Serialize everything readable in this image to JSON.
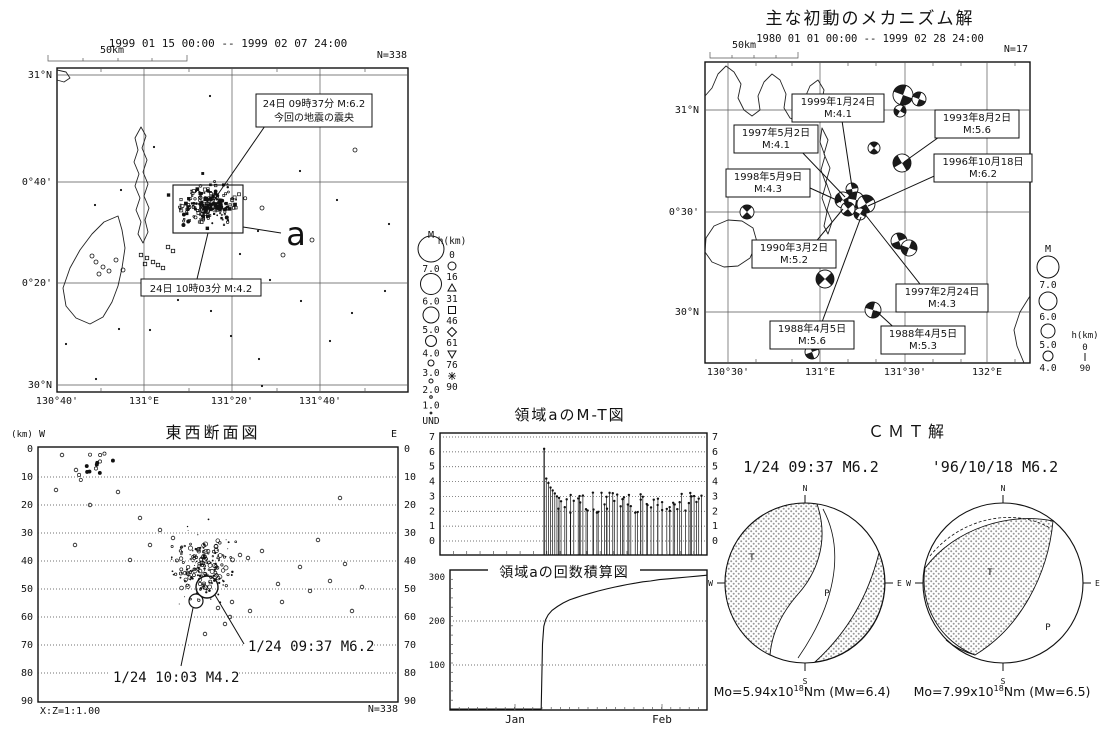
{
  "colors": {
    "ink": "#111111",
    "paper": "#ffffff",
    "hatch": "#8f8f8f"
  },
  "panel_a": {
    "period": "1999 01 15 00:00 -- 1999 02 07 24:00",
    "scale_label": "50km",
    "count_label": "N=338",
    "lat_ticks": [
      "31°N",
      "0°40'",
      "0°20'",
      "30°N"
    ],
    "lon_ticks": [
      "130°40'",
      "131°E",
      "131°20'",
      "131°40'"
    ],
    "callout_main_line1": "24日 09時37分 M:6.2",
    "callout_main_line2": "今回の地震の震央",
    "callout_aftershock": "24日 10時03分 M:4.2",
    "region_label": "a",
    "legend": {
      "m_header": "M",
      "m_items": [
        "7.0",
        "6.0",
        "5.0",
        "4.0",
        "3.0",
        "2.0",
        "1.0",
        "UND"
      ],
      "h_header": "h(km)",
      "h_items": [
        "0",
        "16",
        "31",
        "46",
        "61",
        "76",
        "90"
      ]
    }
  },
  "panel_b": {
    "title": "主な初動のメカニズム解",
    "period": "1980 01 01 00:00 -- 1999 02 28 24:00",
    "scale_label": "50km",
    "count_label": "N=17",
    "lat_ticks": [
      "31°N",
      "0°30'",
      "30°N"
    ],
    "lon_ticks": [
      "130°30'",
      "131°E",
      "131°30'",
      "132°E"
    ],
    "callouts": [
      {
        "date": "1999年1月24日",
        "mag": "M:4.1"
      },
      {
        "date": "1993年8月2日",
        "mag": "M:5.6"
      },
      {
        "date": "1997年5月2日",
        "mag": "M:4.1"
      },
      {
        "date": "1998年5月9日",
        "mag": "M:4.3"
      },
      {
        "date": "1996年10月18日",
        "mag": "M:6.2"
      },
      {
        "date": "1990年3月2日",
        "mag": "M:5.2"
      },
      {
        "date": "1997年2月24日",
        "mag": "M:4.3"
      },
      {
        "date": "1988年4月5日",
        "mag": "M:5.6"
      },
      {
        "date": "1988年4月5日",
        "mag": "M:5.3"
      }
    ],
    "legend": {
      "m_header": "M",
      "m_items": [
        "7.0",
        "6.0",
        "5.0",
        "4.0"
      ],
      "h_header": "h(km)",
      "h_top": "0",
      "h_bottom": "90"
    }
  },
  "panel_c": {
    "title": "東西断面図",
    "unit": "(km)",
    "west": "W",
    "east": "E",
    "depth_ticks": [
      "0",
      "10",
      "20",
      "30",
      "40",
      "50",
      "60",
      "70",
      "80",
      "90"
    ],
    "ratio": "X:Z=1:1.00",
    "count_label": "N=338",
    "label_mainshock": "1/24 09:37 M6.2",
    "label_aftershock": "1/24 10:03 M4.2"
  },
  "panel_d": {
    "title": "領域aのM-T図",
    "y_ticks": [
      "7",
      "6",
      "5",
      "4",
      "3",
      "2",
      "1",
      "0"
    ]
  },
  "panel_e": {
    "title": "領域aの回数積算図",
    "y_ticks": [
      "300",
      "200",
      "100"
    ],
    "x_ticks": [
      "Jan",
      "Feb"
    ]
  },
  "panel_f": {
    "title": "ＣＭＴ解",
    "compass": [
      "N",
      "W",
      "E",
      "S"
    ],
    "t_label": "T",
    "p_label": "P",
    "events": [
      {
        "title": "1/24 09:37 M6.2",
        "mo_prefix": "Mo=5.94x10",
        "mo_exp": "18",
        "mo_suffix": "Nm (Mw=6.4)"
      },
      {
        "title": "'96/10/18 M6.2",
        "mo_prefix": "Mo=7.99x10",
        "mo_exp": "18",
        "mo_suffix": "Nm (Mw=6.5)"
      }
    ]
  },
  "chart_data": [
    {
      "id": "epicenter-map",
      "type": "scatter",
      "title": "1999 01 15 00:00 -- 1999 02 07 24:00",
      "n": 338,
      "lon_ticks": [
        "130°40'",
        "131°E",
        "131°20'",
        "131°40'"
      ],
      "lat_ticks": [
        "31°N",
        "0°40'",
        "0°20'",
        "30°N"
      ],
      "mainshock": {
        "label": "24日 09時37分 M:6.2",
        "m": 6.2,
        "note": "今回の地震の震央"
      },
      "aftershock": {
        "label": "24日 10時03分 M:4.2",
        "m": 4.2
      },
      "region": "a",
      "cluster": {
        "approx_lon": "131°15'",
        "approx_lat": "30°35'",
        "n_points": 210
      },
      "background_n_points": 36,
      "legend_m": [
        7.0,
        6.0,
        5.0,
        4.0,
        3.0,
        2.0,
        1.0,
        "UND"
      ],
      "legend_h_km": [
        0,
        16,
        31,
        46,
        61,
        76,
        90
      ]
    },
    {
      "id": "mechanism-map",
      "type": "scatter",
      "title": "主な初動のメカニズム解",
      "period": "1980 01 01 00:00 -- 1999 02 28 24:00",
      "n": 17,
      "lon_ticks": [
        "130°30'",
        "131°E",
        "131°30'",
        "132°E"
      ],
      "lat_ticks": [
        "31°N",
        "0°30'",
        "30°N"
      ],
      "events": [
        {
          "date": "1999年1月24日",
          "m": 4.1
        },
        {
          "date": "1993年8月2日",
          "m": 5.6
        },
        {
          "date": "1997年5月2日",
          "m": 4.1
        },
        {
          "date": "1998年5月9日",
          "m": 4.3
        },
        {
          "date": "1996年10月18日",
          "m": 6.2
        },
        {
          "date": "1990年3月2日",
          "m": 5.2
        },
        {
          "date": "1997年2月24日",
          "m": 4.3
        },
        {
          "date": "1988年4月5日",
          "m": 5.6
        },
        {
          "date": "1988年4月5日",
          "m": 5.3
        }
      ],
      "legend_m": [
        7.0,
        6.0,
        5.0,
        4.0
      ],
      "legend_h_km": [
        0,
        90
      ]
    },
    {
      "id": "ew-cross-section",
      "type": "scatter",
      "title": "東西断面図",
      "depth_range_km": [
        0,
        90
      ],
      "main_cluster_depth_km": [
        30,
        55
      ],
      "mainshock": {
        "label": "1/24 09:37 M6.2",
        "depth_km": 49,
        "m": 6.2
      },
      "aftershock": {
        "label": "1/24 10:03 M4.2",
        "depth_km": 54,
        "m": 4.2
      },
      "ratio": "X:Z=1:1.00",
      "n": 338
    },
    {
      "id": "mt-plot",
      "type": "stem",
      "title": "領域aのM-T図",
      "ylim": [
        0,
        7
      ],
      "mainshock": {
        "frac": 0.39,
        "m": 6.2
      },
      "early_m": [
        4.2,
        3.9,
        3.6,
        3.4,
        3.2,
        3.0,
        2.9
      ],
      "n_rest": 60,
      "rest_range": [
        1.9,
        3.3
      ],
      "end_frac": 0.99
    },
    {
      "id": "cumulative-count",
      "type": "line",
      "title": "領域aの回数積算図",
      "ylim": [
        0,
        300
      ],
      "x_ticks": [
        "Jan",
        "Feb"
      ],
      "points": [
        [
          0.0,
          0
        ],
        [
          0.355,
          0
        ],
        [
          0.36,
          148
        ],
        [
          0.365,
          188
        ],
        [
          0.372,
          203
        ],
        [
          0.382,
          214
        ],
        [
          0.397,
          224
        ],
        [
          0.418,
          233
        ],
        [
          0.44,
          241
        ],
        [
          0.465,
          248
        ],
        [
          0.49,
          253
        ],
        [
          0.515,
          258
        ],
        [
          0.545,
          263
        ],
        [
          0.575,
          268
        ],
        [
          0.61,
          273
        ],
        [
          0.64,
          277
        ],
        [
          0.665,
          280
        ],
        [
          0.69,
          283
        ],
        [
          0.72,
          286
        ],
        [
          0.75,
          289
        ],
        [
          0.78,
          291
        ],
        [
          0.815,
          294
        ],
        [
          0.85,
          296
        ],
        [
          0.885,
          298
        ],
        [
          0.925,
          300
        ],
        [
          0.965,
          302
        ],
        [
          1.0,
          304
        ]
      ]
    },
    {
      "id": "cmt-solutions",
      "type": "table",
      "title": "ＣＭＴ解",
      "events": [
        {
          "label": "1/24 09:37 M6.2",
          "mo": "5.94x10^18 Nm",
          "mw": 6.4
        },
        {
          "label": "'96/10/18 M6.2",
          "mo": "7.99x10^18 Nm",
          "mw": 6.5
        }
      ]
    }
  ]
}
